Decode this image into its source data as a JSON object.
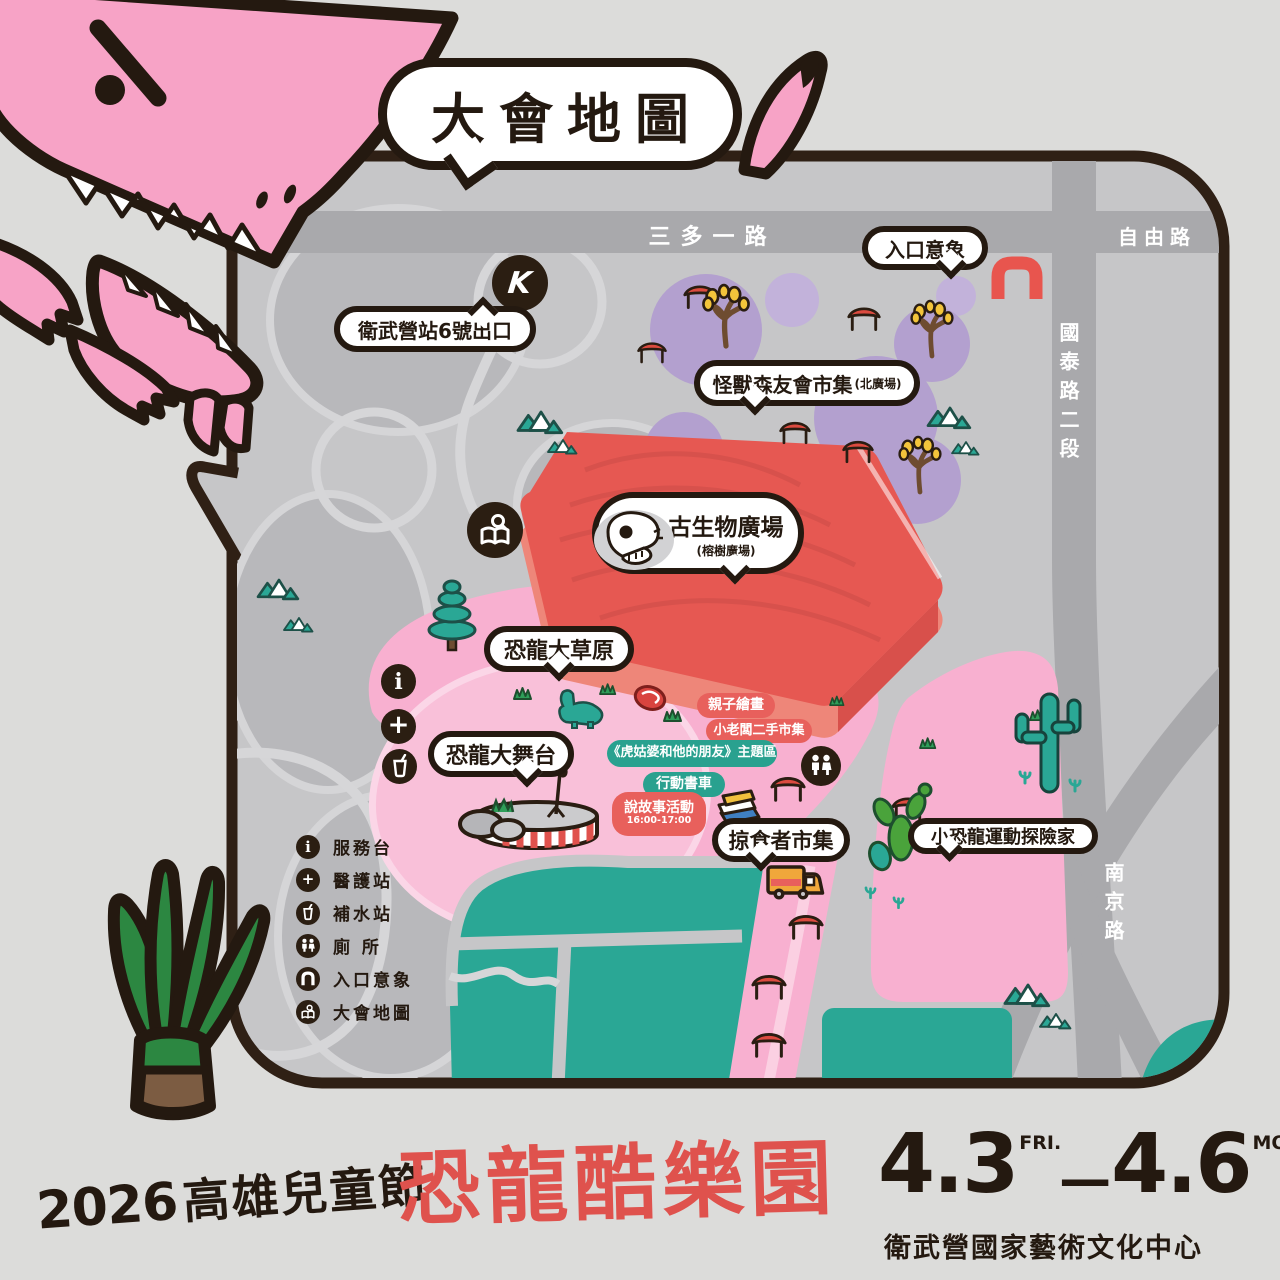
{
  "title_bubble": "大會地圖",
  "glyphs": {
    "mrt": "K",
    "info": "i",
    "medical": "+"
  },
  "roads": {
    "sanduo_rd": "三多一路",
    "ziyou_rd": "自由路",
    "guotai_rd": "國泰路二段",
    "nanjing_rd": "南京路"
  },
  "map": {
    "mrt_exit": "衛武營站6號出口",
    "entrance": "入口意象",
    "monster_market": "怪獸森友會市集",
    "monster_market_sub": "(北廣場)",
    "paleo_plaza": "古生物廣場",
    "paleo_plaza_sub": "(榕樹廣場)",
    "grassland": "恐龍大草原",
    "stage": "恐龍大舞台",
    "predator_market": "掠食者市集",
    "explorer": "小恐龍運動探險家",
    "family_painting": "親子繪畫",
    "kid_boss_market": "小老闆二手市集",
    "tiger_theme": "《虎姑婆和他的朋友》主題區",
    "book_truck": "行動書車",
    "storytime": "說故事活動",
    "storytime_time": "16:00-17:00"
  },
  "legend": {
    "items": [
      {
        "icon": "info-icon",
        "label": "服務台"
      },
      {
        "icon": "medical-icon",
        "label": "醫護站"
      },
      {
        "icon": "water-icon",
        "label": "補水站"
      },
      {
        "icon": "toilet-icon",
        "label": "廁 所"
      },
      {
        "icon": "entrance-icon",
        "label": "入口意象"
      },
      {
        "icon": "map-icon",
        "label": "大會地圖"
      }
    ]
  },
  "footer": {
    "festival_year": "2026",
    "festival_name": "高雄兒童節",
    "event_title": "恐龍酷樂園",
    "date_start": "4.3",
    "date_start_day": "FRI.",
    "date_separator": "—",
    "date_end": "4.6",
    "date_end_day": "MON.",
    "venue": "衛武營國家藝術文化中心"
  },
  "colors": {
    "background": "#dcdcda",
    "map_bg": "#c6c6c8",
    "road": "#a9a9ac",
    "outline": "#241910",
    "pink": "#f8b0d0",
    "dino_pink": "#f7a3c6",
    "teal": "#2aa795",
    "purple": "#b3a0cf",
    "plaza_red": "#e65852",
    "label_red": "#e8605c",
    "label_teal": "#29a18f",
    "title_red": "#df524d"
  }
}
